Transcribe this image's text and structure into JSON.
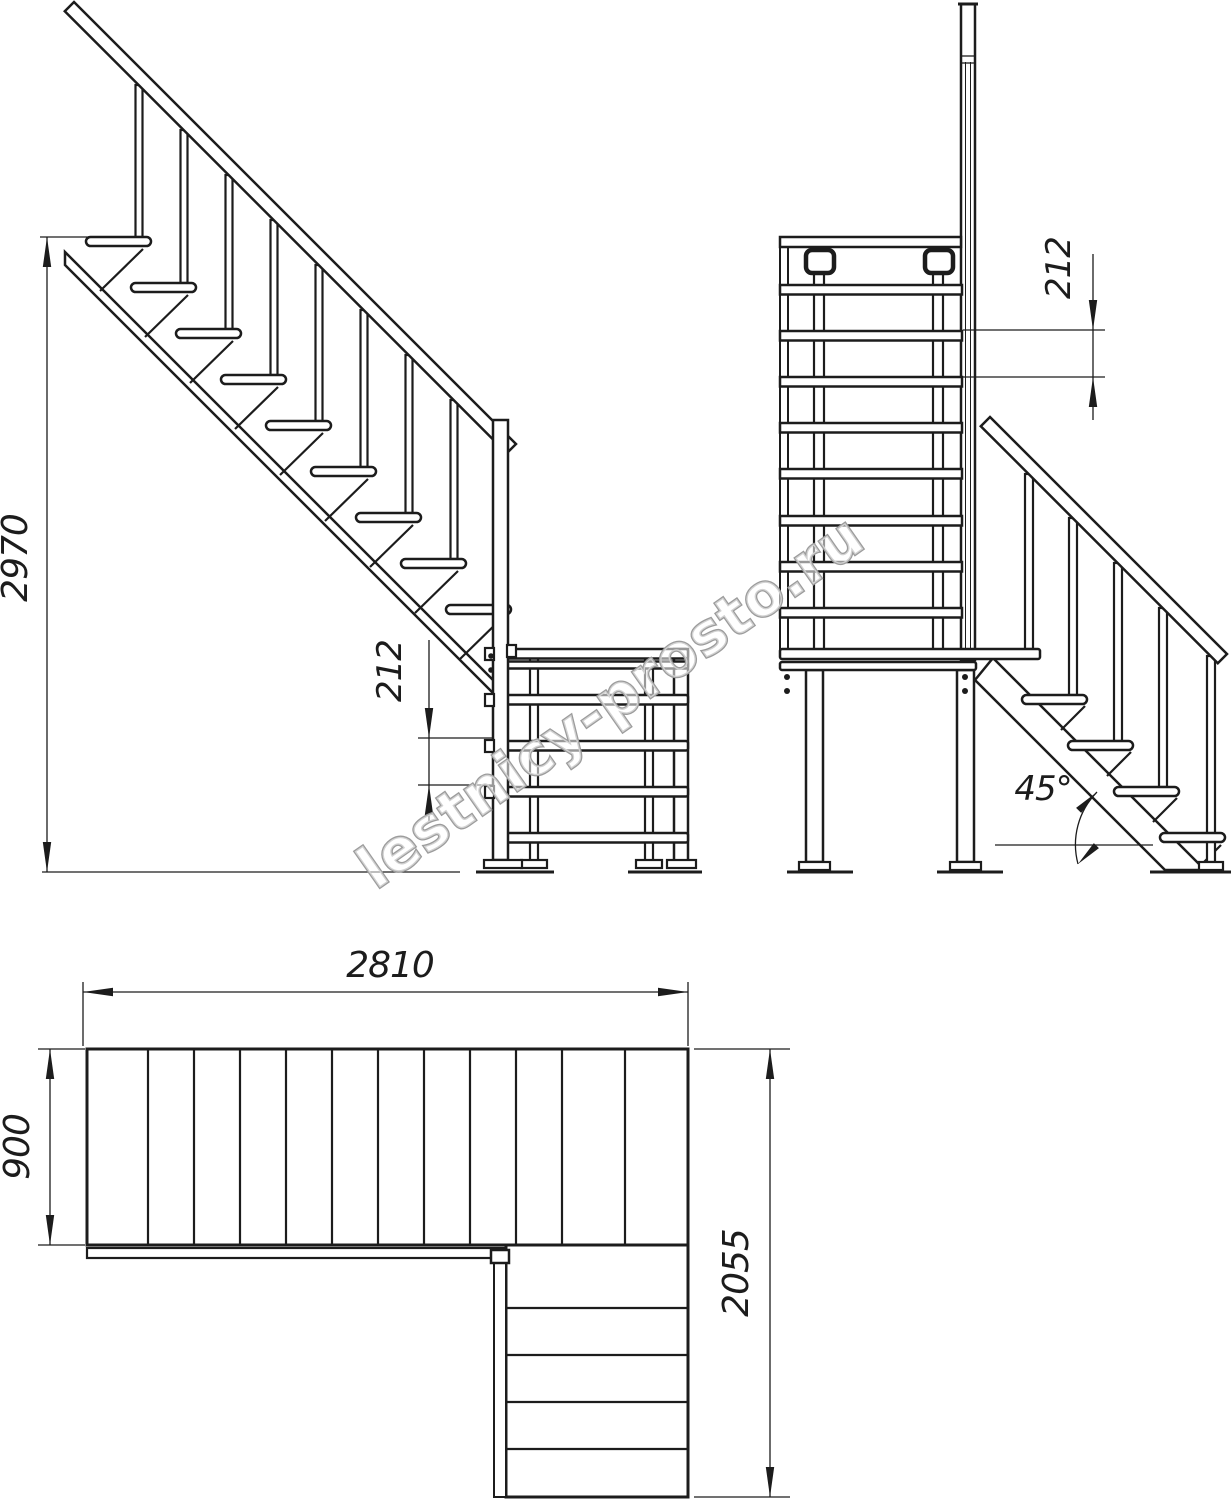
{
  "watermark": {
    "text": "lestnicy-prosto.ru"
  },
  "views": {
    "side": {
      "name": "side-elevation",
      "total_height": "2970",
      "riser_height": "212"
    },
    "front": {
      "name": "front-elevation",
      "riser_height": "212",
      "stair_angle": "45°"
    },
    "plan": {
      "name": "plan-view",
      "flight_length": "2810",
      "flight_width": "900",
      "total_depth": "2055"
    }
  }
}
